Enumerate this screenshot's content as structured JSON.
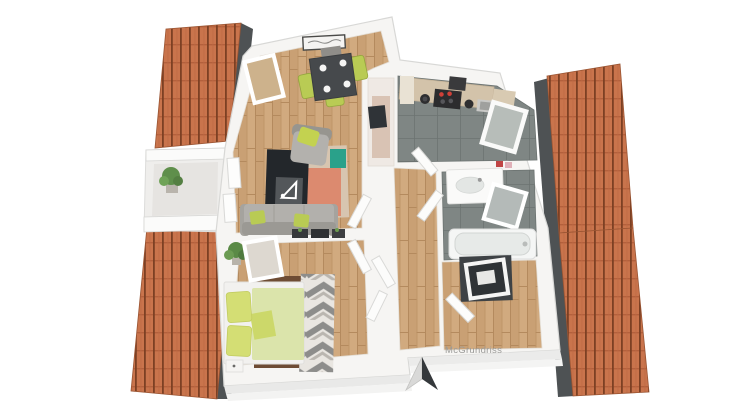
{
  "scene": {
    "type": "3d-floor-plan-render",
    "view": "top-down isometric",
    "subject": "attic apartment with sloped orange tile roofs"
  },
  "watermark": {
    "text": "McGrundriss"
  },
  "compass": {
    "type": "north-arrow",
    "direction": "up"
  },
  "colors": {
    "background": "#ffffff",
    "roof_tile": "#c9744c",
    "roof_ridge_line": "#7c4023",
    "gutter_dark": "#4e5254",
    "wall_white": "#f6f5f3",
    "wall_edge": "#d8d8d6",
    "wood_floor": "#d1aa7f",
    "tile_floor": "#7f8684",
    "sofa_gray": "#b2b0ac",
    "accent_green": "#b9cb54",
    "table_dark": "#46494c",
    "bed_duvet_green": "#dbe4ab",
    "pillow_green": "#d4de74",
    "bed_rug_brown": "#6e4c34",
    "rug_coral": "#dc8a6f",
    "rug_teal": "#2aa18a",
    "rug_tan": "#d7c5b0",
    "tv_board_dark": "#23272b",
    "watermark_gray": "#9b9b99",
    "arrow_dark": "#34383b",
    "arrow_light": "#d9d9d8"
  },
  "rooms": [
    {
      "name": "living-dining-room",
      "floor": "hardwood"
    },
    {
      "name": "kitchen",
      "floor": "gray-tile"
    },
    {
      "name": "bathroom",
      "floor": "gray-tile"
    },
    {
      "name": "hallway",
      "floor": "hardwood"
    },
    {
      "name": "bedroom",
      "floor": "hardwood"
    },
    {
      "name": "storage-room",
      "floor": "hardwood"
    },
    {
      "name": "balcony",
      "floor": "concrete"
    }
  ],
  "furniture": {
    "dining": [
      "dining-table",
      "green-chairs",
      "wall-picture"
    ],
    "living": [
      "sofa",
      "armchair",
      "tv-lowboard-with-logo",
      "area-rug",
      "wall-shelf"
    ],
    "kitchen": [
      "counter",
      "cooktop",
      "pots",
      "sink",
      "skylight-window"
    ],
    "bathroom": [
      "washbasin",
      "mirror-skylight",
      "bathtub"
    ],
    "bedroom": [
      "double-bed",
      "chevron-rug",
      "nightstand",
      "plant",
      "skylight-window"
    ],
    "storage": [
      "dark-closet",
      "skylight-window"
    ],
    "balcony": [
      "railing",
      "plant"
    ]
  }
}
